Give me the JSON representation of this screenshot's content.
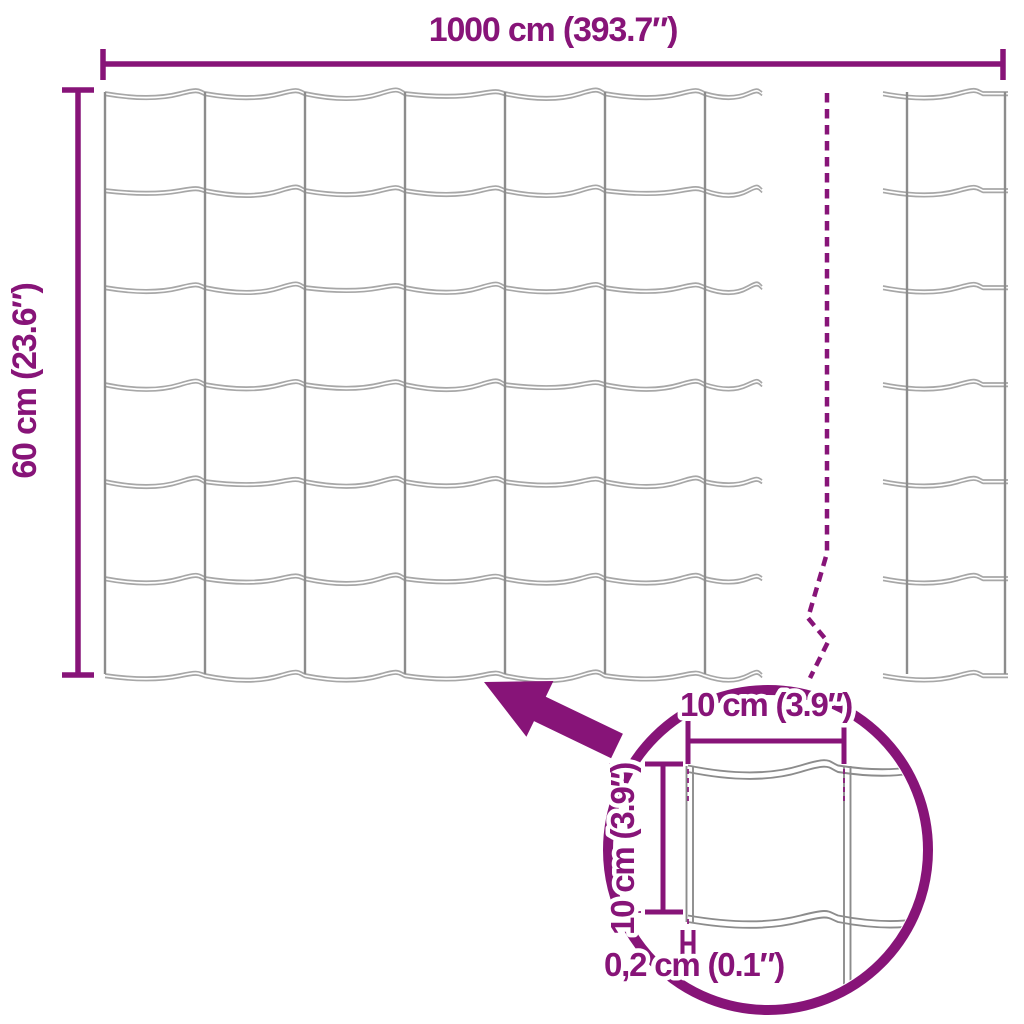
{
  "diagram": {
    "kind": "fence-mesh-dimension-diagram",
    "labels": {
      "total_width": "1000 cm (393.7″)",
      "total_height": "60 cm (23.6″)",
      "mesh_cell_width": "10 cm (3.9″)",
      "mesh_cell_height": "10 cm (3.9″)",
      "wire_thickness": "0,2 cm (0.1″)"
    },
    "colors": {
      "accent": "#871478",
      "wire": "#A7A7A7",
      "wire_dark": "#8C8C8C",
      "background": "#FFFFFF"
    },
    "mesh": {
      "main": {
        "left": 105,
        "top": 92,
        "posts": 7,
        "wires": 7,
        "cell_w": 100,
        "cell_h": 97,
        "wire_end": 762,
        "bottom": 674
      },
      "right_piece": {
        "wire_start": 883,
        "wire_end": 1008,
        "posts": [
          907,
          1005
        ]
      },
      "lens": {
        "cx": 768,
        "cy": 850,
        "r": 160
      }
    }
  }
}
